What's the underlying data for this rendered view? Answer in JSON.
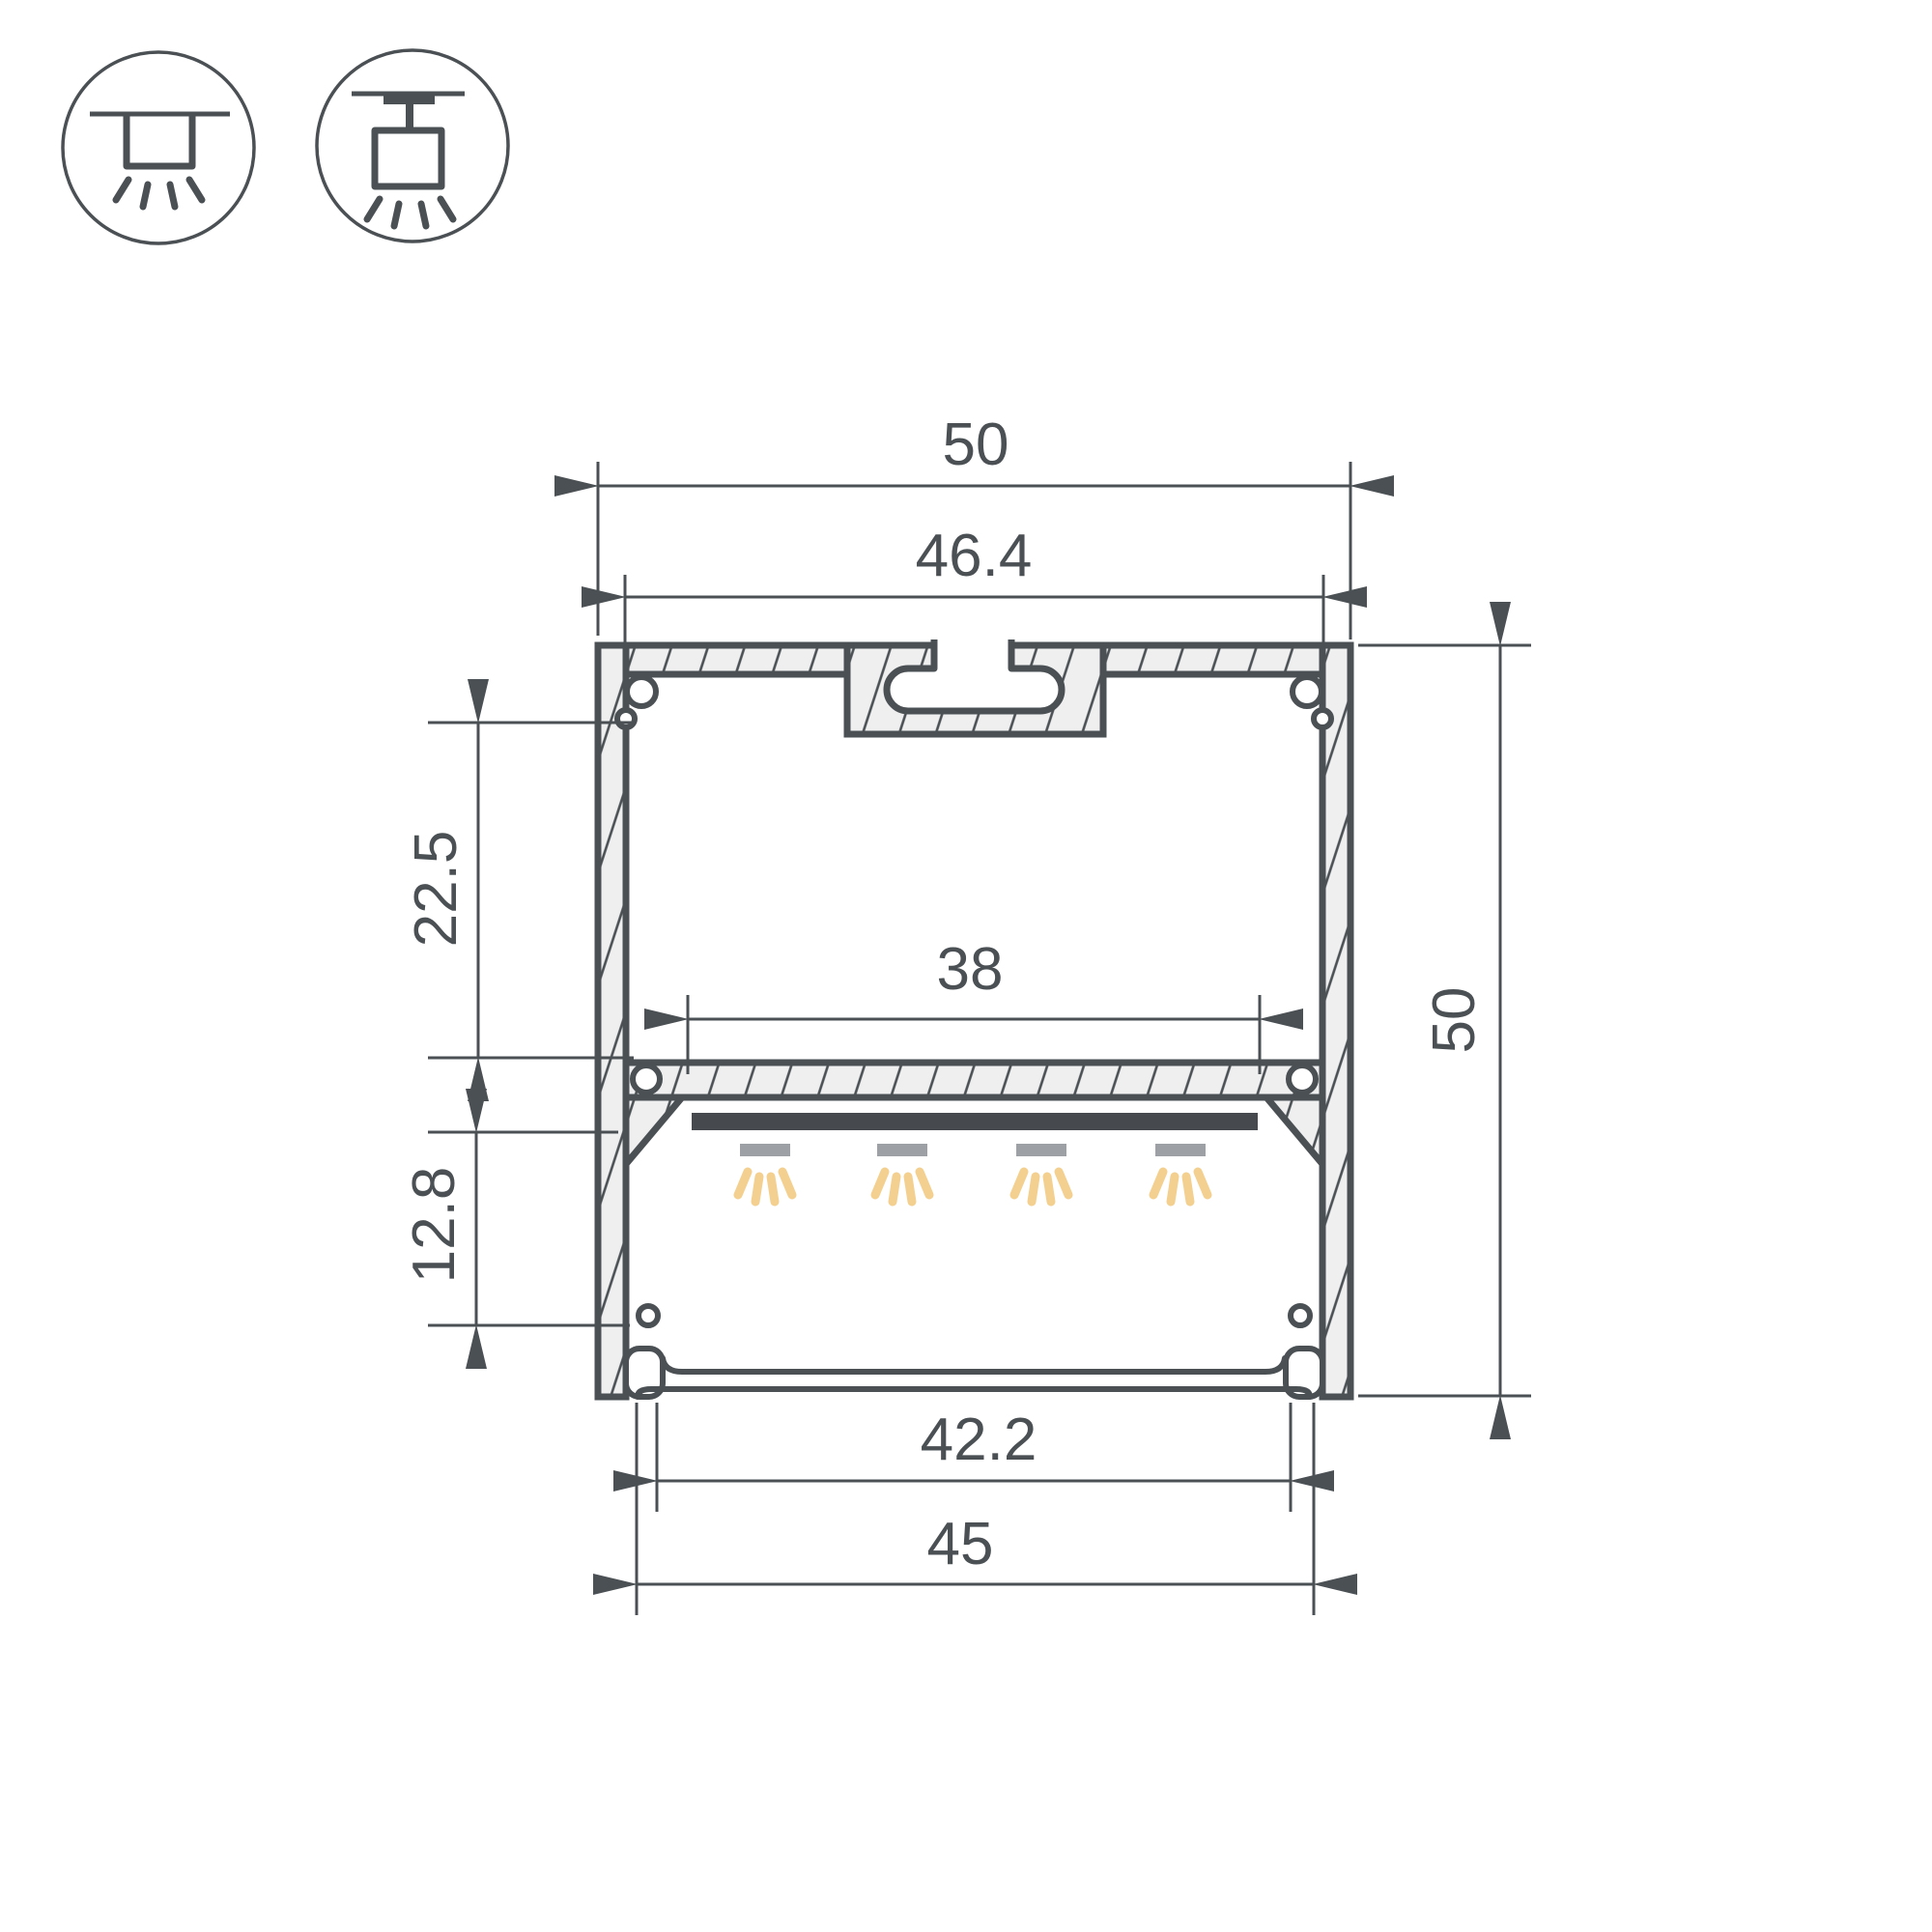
{
  "drawing": {
    "type": "led-profile-cross-section-dimension-drawing"
  },
  "icons": {
    "first": "ceiling-surface-mount-icon",
    "second": "ceiling-pendant-suspended-mount-icon"
  },
  "dimensions": {
    "overall_width": "50",
    "top_inner_width": "46.4",
    "led_shelf_width": "38",
    "upper_chamber_height": "22.5",
    "lower_chamber_height": "12.8",
    "diffuser_width": "42.2",
    "bottom_width": "45",
    "overall_height": "50"
  },
  "colors": {
    "line": "#4A5054",
    "hatch_fill": "#EFEFEF",
    "led_strip": "#46494D",
    "led_module": "#9DA1A5",
    "light_ray": "#F3D08F",
    "background": "#FFFFFF"
  }
}
